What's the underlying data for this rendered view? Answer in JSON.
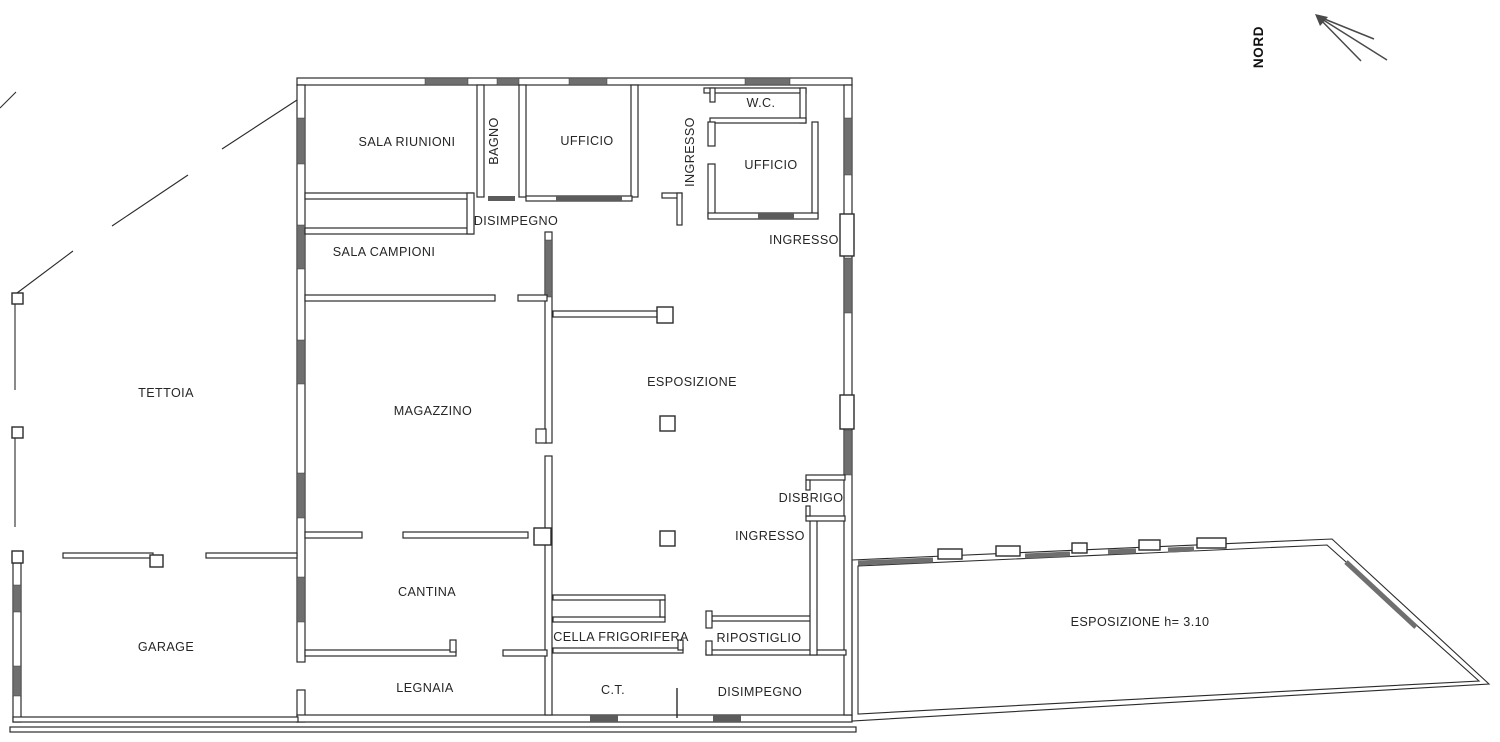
{
  "rooms": {
    "sala_riunioni": "SALA RIUNIONI",
    "bagno": "BAGNO",
    "ufficio_top": "UFFICIO",
    "ingresso_vertical": "INGRESSO",
    "wc": "W.C.",
    "ufficio_right": "UFFICIO",
    "disimpegno_top": "DISIMPEGNO",
    "ingresso_top": "INGRESSO",
    "sala_campioni": "SALA CAMPIONI",
    "tettoia": "TETTOIA",
    "magazzino": "MAGAZZINO",
    "esposizione": "ESPOSIZIONE",
    "disbrigo": "DISBRIGO",
    "ingresso_middle": "INGRESSO",
    "cantina": "CANTINA",
    "garage": "GARAGE",
    "cella_frigorifera": "CELLA FRIGORIFERA",
    "ripostiglio": "RIPOSTIGLIO",
    "legnaia": "LEGNAIA",
    "ct": "C.T.",
    "disimpegno_bottom": "DISIMPEGNO",
    "esposizione_wing": "ESPOSIZIONE h= 3.10"
  },
  "compass": {
    "north_label": "NORD"
  },
  "colors": {
    "wall_line": "#2b2b2b",
    "window_fill": "#6f6f6f",
    "background": "#ffffff",
    "label_text": "#262626"
  }
}
